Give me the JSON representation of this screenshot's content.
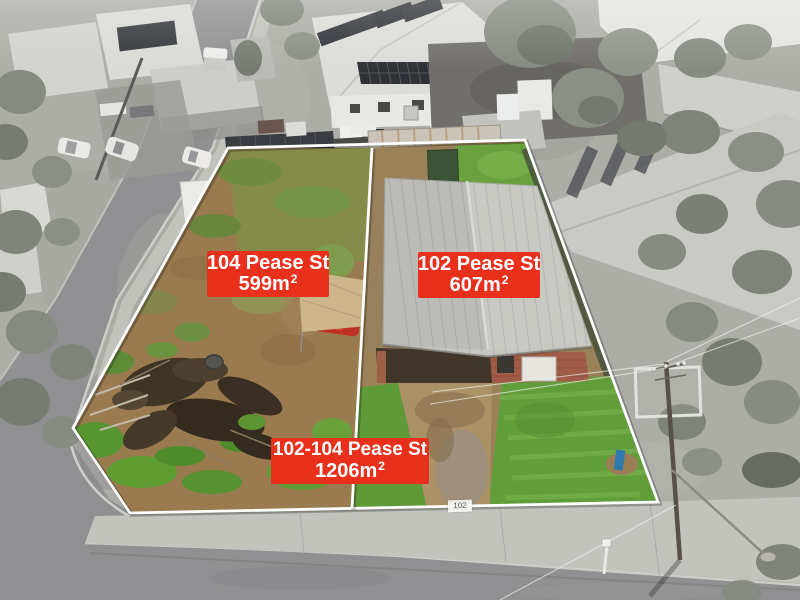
{
  "photo": {
    "type": "aerial-drone-property-photo",
    "grayscale_surroundings": true
  },
  "labels": {
    "lot104": {
      "address": "104 Pease St",
      "area_value": "599m",
      "area_superscript": "2"
    },
    "lot102": {
      "address": "102 Pease St",
      "area_value": "607m",
      "area_superscript": "2"
    },
    "combined": {
      "address": "102-104 Pease St",
      "area_value": "1206m",
      "area_superscript": "2"
    }
  },
  "markers": {
    "house_number_sign": "102"
  },
  "colors": {
    "label_background": "#e8301d",
    "label_text": "#ffffff",
    "boundary_line": "#ffffff"
  }
}
